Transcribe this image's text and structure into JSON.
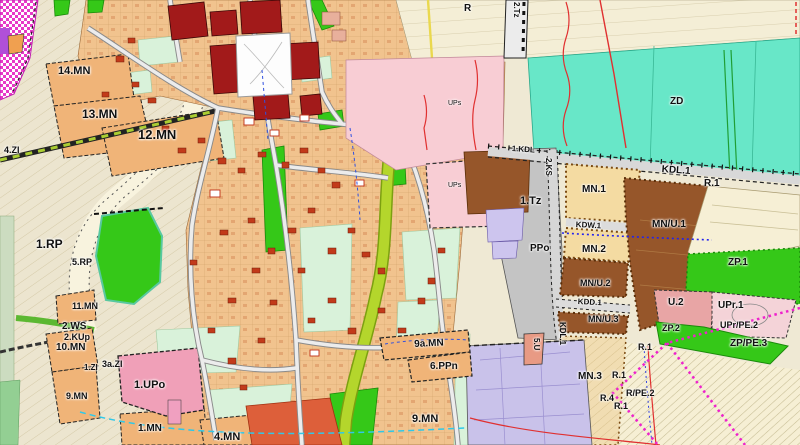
{
  "map": {
    "kind": "municipal zoning plan fragment (land-use map)",
    "palette": {
      "residential_orange": "#f0b478",
      "urban_core_red": "#a21a1a",
      "services_pink": "#f8cdd4",
      "public_green": "#35c818",
      "allotments_teal": "#68e7c8",
      "fields_cream": "#efe9d4",
      "technical_gray": "#c4c4c4",
      "mixed_use_brown": "#96562a",
      "public_lavender": "#c9c2ea",
      "boundary_magenta": "#ee22cc",
      "hazard_red_line": "#e03030",
      "utility_blue": "#3040e0",
      "stream_chartreuse": "#b4d62c"
    }
  },
  "labels": [
    {
      "text": "14.MN"
    },
    {
      "text": "13.MN"
    },
    {
      "text": "12.MN"
    },
    {
      "text": "4.ZI"
    },
    {
      "text": "1.RP"
    },
    {
      "text": "5.RP"
    },
    {
      "text": "11.MN"
    },
    {
      "text": "2.WS"
    },
    {
      "text": "2.KUp"
    },
    {
      "text": "10.MN"
    },
    {
      "text": "1.ZI"
    },
    {
      "text": "3a.ZI"
    },
    {
      "text": "9.MN"
    },
    {
      "text": "1.UPo"
    },
    {
      "text": "1.MN"
    },
    {
      "text": "4.MN"
    },
    {
      "text": "UPs"
    },
    {
      "text": "UPs"
    },
    {
      "text": "R"
    },
    {
      "text": "2.Tz"
    },
    {
      "text": "ZD"
    },
    {
      "text": "1.KDL"
    },
    {
      "text": "2.KS"
    },
    {
      "text": "1.Tz"
    },
    {
      "text": "PPo"
    },
    {
      "text": "MN.1"
    },
    {
      "text": "KDW.1"
    },
    {
      "text": "MN.2"
    },
    {
      "text": "MN/U.2"
    },
    {
      "text": "KDD.1"
    },
    {
      "text": "MN/U.3"
    },
    {
      "text": "KDL.1"
    },
    {
      "text": "5.U"
    },
    {
      "text": "MN.3"
    },
    {
      "text": "R.1"
    },
    {
      "text": "R.4"
    },
    {
      "text": "R.1"
    },
    {
      "text": "R/PE.2"
    },
    {
      "text": "KDL.1"
    },
    {
      "text": "R.1"
    },
    {
      "text": "MN/U.1"
    },
    {
      "text": "ZP.1"
    },
    {
      "text": "U.2"
    },
    {
      "text": "UPr.1"
    },
    {
      "text": "ZP.2"
    },
    {
      "text": "UPr/PE.2"
    },
    {
      "text": "ZP/PE.3"
    },
    {
      "text": "R.1"
    },
    {
      "text": "9a.MN"
    },
    {
      "text": "6.PPn"
    },
    {
      "text": "9.MN"
    }
  ]
}
